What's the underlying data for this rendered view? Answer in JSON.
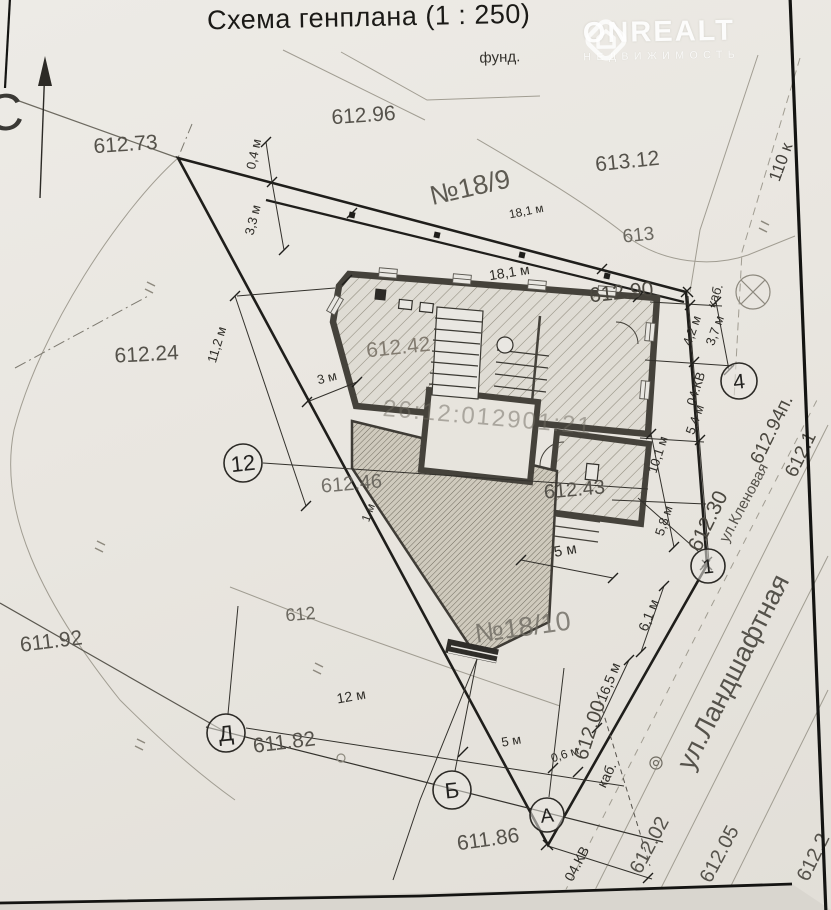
{
  "title": "Схема генплана (1 : 250)",
  "watermark": {
    "brand": "ONREALT",
    "subtitle": "НЕДВИЖИМОСТЬ"
  },
  "colors": {
    "paper": "#e9e6e0",
    "ink": "#2b2a26",
    "wall": "#45423b"
  },
  "cadastral_number": "26:12:012901:21",
  "parcels": [
    "№18/9",
    "№18/10"
  ],
  "streets": [
    "ул.Кленовая",
    "ул.Ландшафтная"
  ],
  "labels": [
    {
      "name": "north-letter",
      "text": "С",
      "x": 6,
      "y": 130,
      "rot": -5,
      "size": 52,
      "color": "#3a3935"
    },
    {
      "name": "label-fund",
      "text": "фунд.",
      "x": 500,
      "y": 62,
      "rot": -2,
      "size": 15,
      "color": "#33312c"
    },
    {
      "name": "elev-612-96",
      "text": "612.96",
      "x": 364,
      "y": 122,
      "rot": -4,
      "size": 21,
      "color": "#55524b"
    },
    {
      "name": "elev-612-73",
      "text": "612.73",
      "x": 126,
      "y": 151,
      "rot": -4,
      "size": 21,
      "color": "#55524b"
    },
    {
      "name": "elev-613-12",
      "text": "613.12",
      "x": 628,
      "y": 168,
      "rot": -6,
      "size": 21,
      "color": "#55524b"
    },
    {
      "name": "parcel-no-18-9",
      "text": "№18/9",
      "x": 472,
      "y": 196,
      "rot": -13,
      "size": 27,
      "color": "#454239",
      "o": 0.85
    },
    {
      "name": "dim-18-1-upper",
      "text": "18,1 м",
      "x": 527,
      "y": 215,
      "rot": -11,
      "size": 12,
      "color": "#2e2c27"
    },
    {
      "name": "contour-613",
      "text": "613",
      "x": 639,
      "y": 241,
      "rot": -6,
      "size": 19,
      "color": "#6b6860"
    },
    {
      "name": "dim-18-1",
      "text": "18,1 м",
      "x": 510,
      "y": 277,
      "rot": -9,
      "size": 14,
      "color": "#2e2c27"
    },
    {
      "name": "elev-612-90",
      "text": "612.90",
      "x": 622,
      "y": 299,
      "rot": -6,
      "size": 21,
      "color": "#4a473f"
    },
    {
      "name": "dim-0-4",
      "text": "0,4 м",
      "x": 258,
      "y": 155,
      "rot": -78,
      "size": 13,
      "color": "#2e2c27"
    },
    {
      "name": "dim-3-3",
      "text": "3,3 м",
      "x": 257,
      "y": 221,
      "rot": -76,
      "size": 13,
      "color": "#2e2c27"
    },
    {
      "name": "elev-612-24",
      "text": "612.24",
      "x": 147,
      "y": 361,
      "rot": -3,
      "size": 21,
      "color": "#55524b"
    },
    {
      "name": "elev-612-42",
      "text": "612.42",
      "x": 399,
      "y": 354,
      "rot": -6,
      "size": 21,
      "color": "#787166",
      "o": 0.9
    },
    {
      "name": "dim-11-2",
      "text": "11,2 м",
      "x": 221,
      "y": 346,
      "rot": -73,
      "size": 13,
      "color": "#2e2c27"
    },
    {
      "name": "dim-3",
      "text": "3 м",
      "x": 328,
      "y": 382,
      "rot": -14,
      "size": 13,
      "color": "#2e2c27"
    },
    {
      "name": "cable-label-top",
      "text": "каб.",
      "x": 719,
      "y": 297,
      "rot": -70,
      "size": 13,
      "color": "#2e2c27"
    },
    {
      "name": "dim-4-2",
      "text": "4,2 м",
      "x": 696,
      "y": 332,
      "rot": -70,
      "size": 13,
      "color": "#2e2c27"
    },
    {
      "name": "dim-3-7",
      "text": "3,7 м",
      "x": 719,
      "y": 332,
      "rot": -70,
      "size": 13,
      "color": "#2e2c27"
    },
    {
      "name": "cadastral-number",
      "text": "26:12:012901:21",
      "x": 487,
      "y": 425,
      "rot": 5,
      "size": 24,
      "color": "#6e6a60",
      "o": 0.5,
      "ls": 2
    },
    {
      "name": "power-04kv-right",
      "text": "04.КВ",
      "x": 700,
      "y": 390,
      "rot": -72,
      "size": 13,
      "color": "#2e2c27"
    },
    {
      "name": "dim-5-4",
      "text": "5,4 м",
      "x": 699,
      "y": 421,
      "rot": -70,
      "size": 13,
      "color": "#2e2c27"
    },
    {
      "name": "elev-612-94p",
      "text": "612.94п.",
      "x": 777,
      "y": 432,
      "rot": -64,
      "size": 19,
      "color": "#4a473f"
    },
    {
      "name": "elev-612-1",
      "text": "612.1",
      "x": 806,
      "y": 457,
      "rot": -64,
      "size": 19,
      "color": "#4a473f"
    },
    {
      "name": "street-klenovaya",
      "text": "ул.Кленовая",
      "x": 748,
      "y": 505,
      "rot": -62,
      "size": 15,
      "color": "#55524b"
    },
    {
      "name": "elev-612-30",
      "text": "612.30",
      "x": 714,
      "y": 524,
      "rot": -64,
      "size": 21,
      "color": "#4a473f"
    },
    {
      "name": "dim-10-1",
      "text": "10,1 м",
      "x": 662,
      "y": 456,
      "rot": -72,
      "size": 13,
      "color": "#2e2c27"
    },
    {
      "name": "dim-5-8",
      "text": "5,8 м",
      "x": 668,
      "y": 522,
      "rot": -72,
      "size": 13,
      "color": "#2e2c27"
    },
    {
      "name": "elev-612-43",
      "text": "612.43",
      "x": 575,
      "y": 496,
      "rot": -5,
      "size": 20,
      "color": "#55524b"
    },
    {
      "name": "elev-612-46",
      "text": "612.46",
      "x": 352,
      "y": 490,
      "rot": -5,
      "size": 20,
      "color": "#5f5c55",
      "o": 0.85
    },
    {
      "name": "dim-1",
      "text": "1 м",
      "x": 372,
      "y": 514,
      "rot": -70,
      "size": 12,
      "color": "#2e2c27"
    },
    {
      "name": "dim-5-center",
      "text": "5 м",
      "x": 566,
      "y": 555,
      "rot": -10,
      "size": 15,
      "color": "#2e2c27"
    },
    {
      "name": "parcel-no-18-10",
      "text": "№18/10",
      "x": 524,
      "y": 636,
      "rot": -8,
      "size": 27,
      "color": "#6e6b62",
      "o": 0.8
    },
    {
      "name": "dim-6-1",
      "text": "6,1 м",
      "x": 653,
      "y": 617,
      "rot": -68,
      "size": 14,
      "color": "#2e2c27"
    },
    {
      "name": "dim-16-5",
      "text": "16,5 м",
      "x": 613,
      "y": 684,
      "rot": -68,
      "size": 14,
      "color": "#2e2c27"
    },
    {
      "name": "contour-612",
      "text": "612",
      "x": 301,
      "y": 620,
      "rot": -5,
      "size": 18,
      "color": "#6b6860"
    },
    {
      "name": "elev-611-92",
      "text": "611.92",
      "x": 52,
      "y": 648,
      "rot": -7,
      "size": 21,
      "color": "#55524b"
    },
    {
      "name": "dim-12",
      "text": "12 м",
      "x": 352,
      "y": 701,
      "rot": -10,
      "size": 14,
      "color": "#2e2c27"
    },
    {
      "name": "elev-611-82",
      "text": "611.82",
      "x": 285,
      "y": 749,
      "rot": -7,
      "size": 21,
      "color": "#55524b"
    },
    {
      "name": "dim-5-bottom",
      "text": "5 м",
      "x": 512,
      "y": 745,
      "rot": -10,
      "size": 13,
      "color": "#2e2c27"
    },
    {
      "name": "dim-0-6",
      "text": "0,6 м",
      "x": 566,
      "y": 758,
      "rot": -18,
      "size": 12,
      "color": "#2e2c27"
    },
    {
      "name": "elev-612-00",
      "text": "612.00",
      "x": 596,
      "y": 732,
      "rot": -72,
      "size": 20,
      "color": "#4a473f"
    },
    {
      "name": "cable-label-bottom",
      "text": "каб.",
      "x": 611,
      "y": 777,
      "rot": -64,
      "size": 14,
      "color": "#2e2c27"
    },
    {
      "name": "elev-611-86",
      "text": "611.86",
      "x": 489,
      "y": 846,
      "rot": -8,
      "size": 21,
      "color": "#55524b"
    },
    {
      "name": "power-04kv-bottom",
      "text": "04.КВ",
      "x": 581,
      "y": 866,
      "rot": -62,
      "size": 14,
      "color": "#2e2c27"
    },
    {
      "name": "elev-612-02",
      "text": "612.02",
      "x": 655,
      "y": 848,
      "rot": -62,
      "size": 20,
      "color": "#55524b"
    },
    {
      "name": "elev-612-05",
      "text": "612.05",
      "x": 725,
      "y": 857,
      "rot": -62,
      "size": 20,
      "color": "#55524b"
    },
    {
      "name": "elev-612-2",
      "text": "612.2",
      "x": 819,
      "y": 860,
      "rot": -64,
      "size": 20,
      "color": "#55524b"
    },
    {
      "name": "street-landshaftnaya",
      "text": "ул.Ландшафтная",
      "x": 741,
      "y": 676,
      "rot": -63,
      "size": 27,
      "color": "#55524b",
      "w": 500
    },
    {
      "name": "power-110",
      "text": "110 к",
      "x": 786,
      "y": 164,
      "rot": -70,
      "size": 17,
      "color": "#44413b"
    }
  ],
  "axis_markers": [
    {
      "name": "axis-marker-12",
      "label": "12",
      "x": 243,
      "y": 463,
      "r": 19
    },
    {
      "name": "axis-marker-4",
      "label": "4",
      "x": 739,
      "y": 381,
      "r": 18
    },
    {
      "name": "axis-marker-1",
      "label": "1",
      "x": 708,
      "y": 566,
      "r": 17
    },
    {
      "name": "axis-marker-d",
      "label": "Д",
      "x": 226,
      "y": 733,
      "r": 19
    },
    {
      "name": "axis-marker-b",
      "label": "Б",
      "x": 452,
      "y": 790,
      "r": 19
    },
    {
      "name": "axis-marker-a",
      "label": "А",
      "x": 547,
      "y": 815,
      "r": 17
    }
  ]
}
